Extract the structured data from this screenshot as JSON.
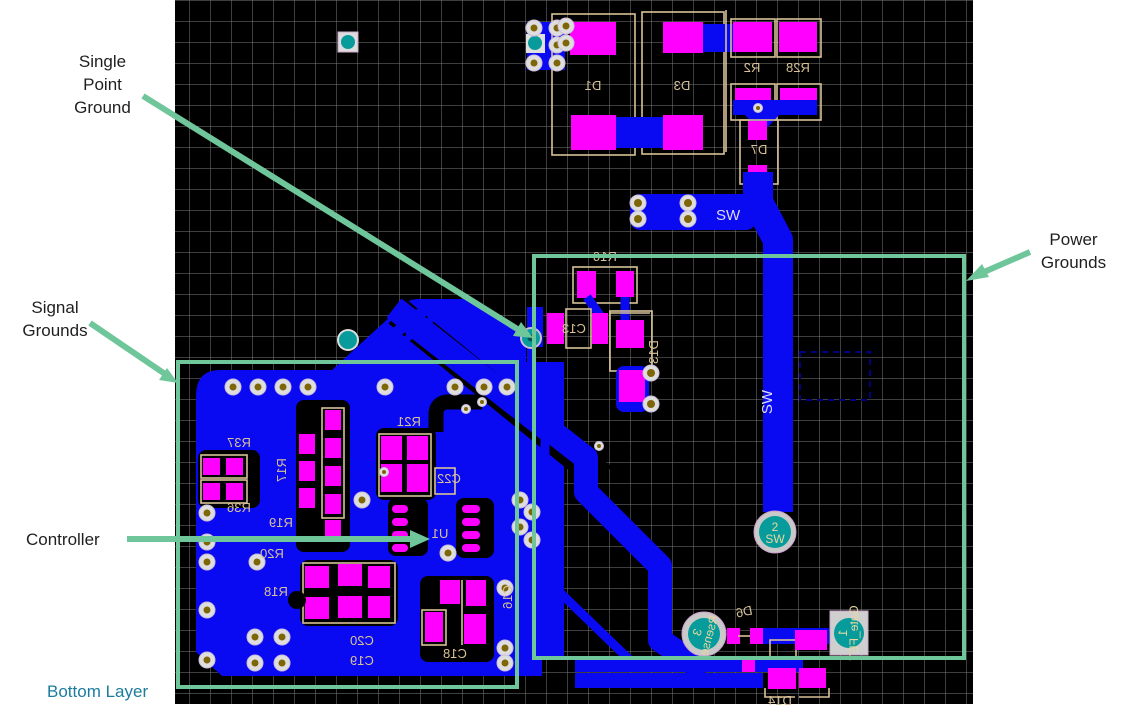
{
  "annotations": {
    "single_point_ground": {
      "lines": [
        "Single",
        "Point",
        "Ground"
      ]
    },
    "signal_grounds": {
      "lines": [
        "Signal",
        "Grounds"
      ]
    },
    "power_grounds": {
      "lines": [
        "Power",
        "Grounds"
      ]
    },
    "controller": {
      "label": "Controller"
    },
    "bottom_layer": {
      "label": "Bottom Layer"
    }
  },
  "board": {
    "refdes": {
      "d1": "D1",
      "d3": "D3",
      "r2": "R2",
      "r28": "R28",
      "d7": "D7",
      "r16": "R16",
      "c13": "C13",
      "d13": "D13",
      "r37": "R37",
      "r36": "R36",
      "r17": "R17",
      "r19": "R19",
      "r20": "R20",
      "r18": "R18",
      "r21": "R21",
      "c22": "C22",
      "u1": "U1",
      "c20": "C20",
      "c19": "C19",
      "c18": "C18",
      "c16": "C16",
      "d6": "D6",
      "d14": "D14"
    },
    "nets": {
      "sw_bar": "SW",
      "sw_trace": "SW"
    },
    "testpoints": {
      "sw": {
        "num": "2",
        "name": "SW"
      },
      "rsense": {
        "num": "3",
        "name": "Rsense"
      },
      "gate_fet": {
        "num": "1",
        "name": "Gate_FET"
      }
    }
  },
  "colors": {
    "copper": "#0a0af2",
    "pad": "#ff00ff",
    "silk": "#d8c297",
    "annot": "#6fc69b",
    "grid": "#7c7c7c",
    "via_teal": "#089b9b",
    "hole": "#7d6508",
    "bottom_label": "#1b7c9e"
  }
}
